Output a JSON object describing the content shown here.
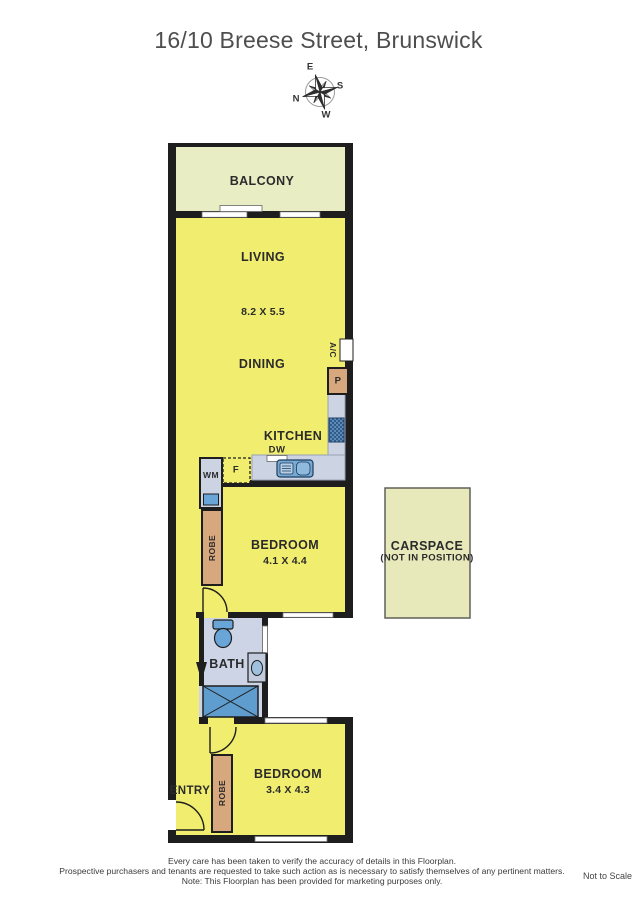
{
  "title": "16/10 Breese Street, Brunswick",
  "compass": {
    "east": "E",
    "south": "S",
    "north": "N",
    "west": "W"
  },
  "rooms": {
    "balcony": {
      "label": "BALCONY"
    },
    "living": {
      "label": "LIVING",
      "dimensions": "8.2 X 5.5"
    },
    "dining": {
      "label": "DINING"
    },
    "kitchen": {
      "label": "KITCHEN"
    },
    "bedroom1": {
      "label": "BEDROOM",
      "dimensions": "4.1 X 4.4"
    },
    "bath": {
      "label": "BATH"
    },
    "entry": {
      "label": "ENTRY"
    },
    "bedroom2": {
      "label": "BEDROOM",
      "dimensions": "3.4 X 4.3"
    },
    "carspace": {
      "label": "CARSPACE",
      "note": "(NOT IN POSITION)"
    }
  },
  "fixtures": {
    "air_conditioner": "A/C",
    "pantry": "P",
    "dishwasher": "DW",
    "fridge": "F",
    "washing_machine": "WM",
    "robe_bedroom1": "ROBE",
    "robe_bedroom2": "ROBE"
  },
  "footer": {
    "line1": "Every care has been taken to verify the accuracy of details in this Floorplan.",
    "line2": "Prospective purchasers and tenants are requested to take such action as is necessary to satisfy themselves of any pertinent matters.",
    "line3": "Note: This Floorplan has been provided for marketing purposes only.",
    "scale_note": "Not to Scale"
  },
  "colors": {
    "room_fill": "#f1ee6f",
    "balcony_fill": "#e9edc3",
    "carspace_fill": "#e7e9ba",
    "wall": "#1e1e1e",
    "joinery_tan": "#d7a87d",
    "bench_blue": "#ccd3e3",
    "bath_floor": "#cdd4e6",
    "fixture_blue": "#6aa5d7",
    "sink_navy": "#2d5c8e"
  }
}
